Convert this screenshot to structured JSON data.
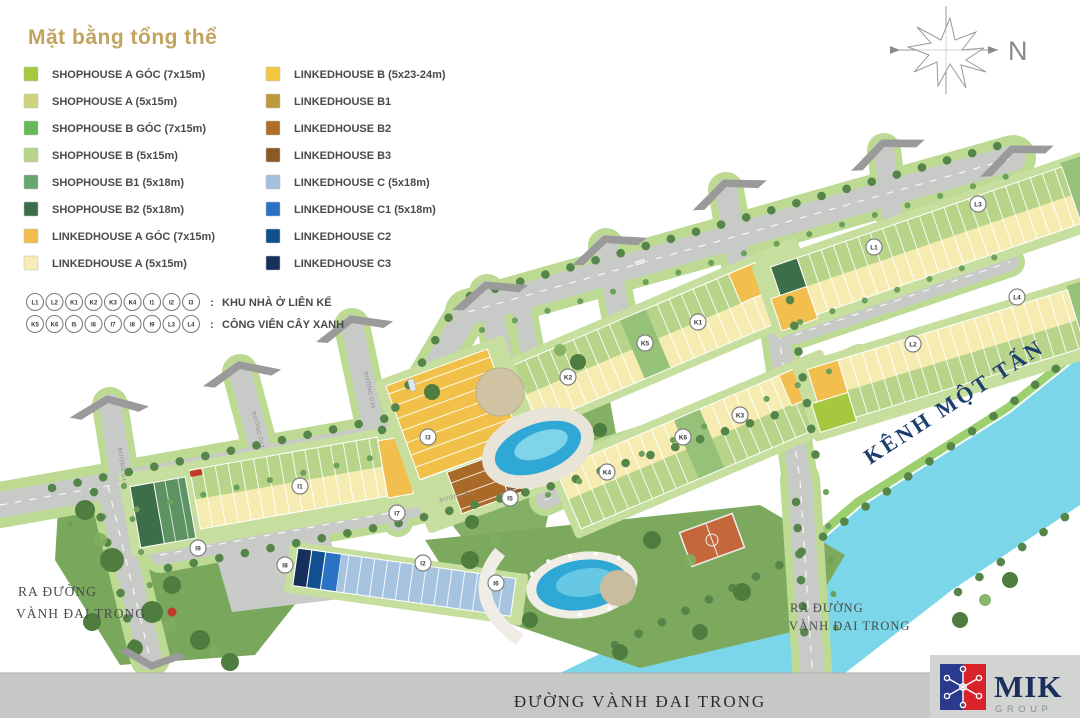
{
  "title": "Mặt bằng tổng thể",
  "legend": {
    "colon": ":",
    "items": [
      {
        "label": "SHOPHOUSE A GÓC (7x15m)",
        "color": "#a5c83e"
      },
      {
        "label": "SHOPHOUSE A  (5x15m)",
        "color": "#ced47b"
      },
      {
        "label": "SHOPHOUSE B GÓC (7x15m)",
        "color": "#66bb58"
      },
      {
        "label": "SHOPHOUSE B  (5x15m)",
        "color": "#b7d489"
      },
      {
        "label": "SHOPHOUSE B1 (5x18m)",
        "color": "#67a571"
      },
      {
        "label": "SHOPHOUSE B2 (5x18m)",
        "color": "#3c6e49"
      },
      {
        "label": "LINKEDHOUSE A GÓC (7x15m)",
        "color": "#f2bf4e"
      },
      {
        "label": "LINKEDHOUSE A (5x15m)",
        "color": "#f7ecb4"
      },
      {
        "label": "LINKEDHOUSE B (5x23-24m)",
        "color": "#f2c843"
      },
      {
        "label": "LINKEDHOUSE B1",
        "color": "#bf9a3b"
      },
      {
        "label": "LINKEDHOUSE B2",
        "color": "#b06f28"
      },
      {
        "label": "LINKEDHOUSE B3",
        "color": "#8a5a23"
      },
      {
        "label": "LINKEDHOUSE C (5x18m)",
        "color": "#a3c0dc"
      },
      {
        "label": "LINKEDHOUSE C1 (5x18m)",
        "color": "#2a72c3"
      },
      {
        "label": "LINKEDHOUSE C2",
        "color": "#10508f"
      },
      {
        "label": "LINKEDHOUSE C3",
        "color": "#16305c"
      }
    ],
    "housing_row": {
      "markers": [
        "L1",
        "L2",
        "K1",
        "K2",
        "K3",
        "K4",
        "I1",
        "I2",
        "I3"
      ],
      "label": "KHU NHÀ Ở LIÊN KẾ"
    },
    "park_row": {
      "markers": [
        "K5",
        "K6",
        "I5",
        "I6",
        "I7",
        "I8",
        "I9",
        "L3",
        "L4"
      ],
      "label": "CÔNG VIÊN CÂY XANH"
    }
  },
  "compass": {
    "label": "N"
  },
  "map": {
    "water_label": "KÊNH MỘT TẤN",
    "exit_left": {
      "line1": "RA ĐƯỜNG",
      "line2": "VÀNH ĐAI TRONG"
    },
    "exit_right": {
      "line1": "RA ĐƯỜNG",
      "line2": "VÀNH ĐAI TRONG"
    },
    "bottom_road": "ĐƯỜNG VÀNH ĐAI TRONG",
    "road_labels": [
      "ĐƯỜNG D14",
      "ĐƯỜNG D12",
      "ĐƯỜNG D10",
      "ĐƯỜNG Đ-7"
    ],
    "markers": [
      "I1",
      "I2",
      "I3",
      "I5",
      "I6",
      "I7",
      "I8",
      "I9",
      "K1",
      "K2",
      "K3",
      "K4",
      "K5",
      "K6",
      "L1",
      "L2",
      "L3",
      "L4"
    ]
  },
  "logo": {
    "name": "MIK",
    "group": "GROUP"
  }
}
